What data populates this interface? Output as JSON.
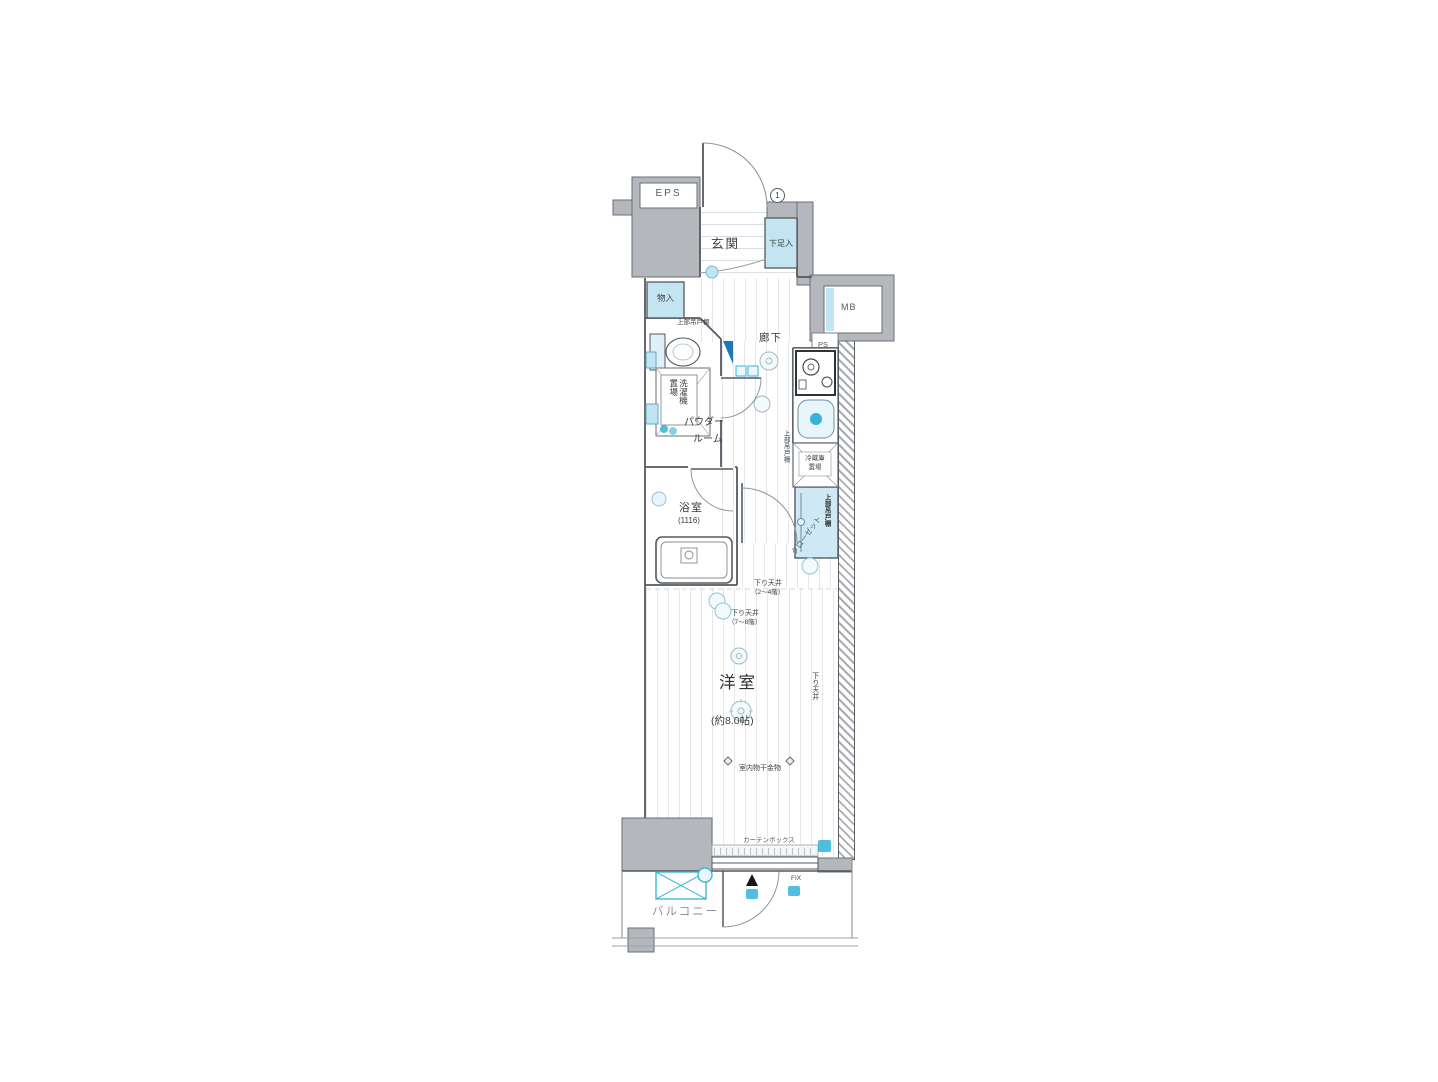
{
  "plan": {
    "type": "apartment-floor-plan-1K",
    "service": {
      "eps": "EPS",
      "mb": "MB",
      "ps": "PS"
    },
    "entrance": {
      "name": "玄関",
      "shoe_box": "下足入",
      "door_mark": "1"
    },
    "corridor": {
      "name": "廊下",
      "storage": "物入",
      "upper_cabinet": "上部吊戸棚"
    },
    "powder_room": {
      "name_line1": "パウダー",
      "name_line2": "ルーム",
      "laundry": "洗濯機置場"
    },
    "bathroom": {
      "name": "浴室",
      "size": "(1116)"
    },
    "kitchen": {
      "fridge_line1": "冷蔵庫",
      "fridge_line2": "置場",
      "upper_cabinet": "上部吊戸棚"
    },
    "closet": {
      "name": "クローゼット",
      "shelf": "上部吊戸棚"
    },
    "main_room": {
      "name": "洋室",
      "size": "(約8.0帖)",
      "down_ceiling": "下り天井",
      "down_ceiling_note_a": "（2～4階）",
      "down_ceiling_note_b": "（7～8階）",
      "drying_fixture": "室内物干金物",
      "curtain_box": "カーテンボックス",
      "fix_window": "FIX"
    },
    "balcony": {
      "name": "バルコニー"
    }
  },
  "colors": {
    "wall_fill": "#b4b8bc",
    "wall_edge": "#6a6e72",
    "line": "#55595d",
    "storage_blue": "#c3e4f1",
    "closet_blue": "#cfe9f4",
    "fixture_teal": "#35b3d9",
    "deep_blue": "#2077b8",
    "floor_stripe": "#e2e8ed"
  }
}
